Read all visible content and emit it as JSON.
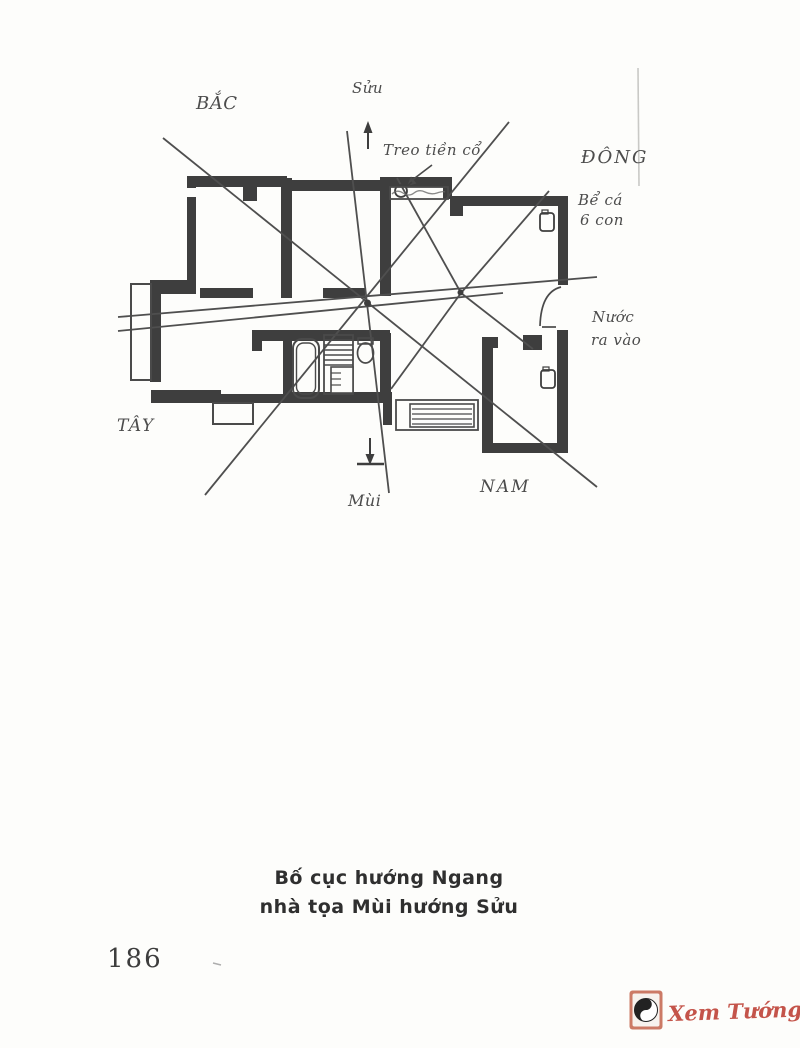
{
  "page": {
    "background": "#fdfdfb",
    "number": "186",
    "caption_line1": "Bố cục hướng Ngang",
    "caption_line2": "nhà tọa Mùi hướng Sửu"
  },
  "diagram": {
    "type": "feng-shui floor plan sketch with compass sector lines",
    "ink_color": "#3e3e3e",
    "labels": {
      "north": "BẮC",
      "north_mountain": "Sửu",
      "east": "ĐÔNG",
      "west": "TÂY",
      "south": "NAM",
      "south_mountain": "Mùi",
      "hang_old_coins": "Treo tiền cổ",
      "fish_tank_line1": "Bể cá",
      "fish_tank_line2": "6 con",
      "water_line1": "Nước",
      "water_line2": "ra vào"
    }
  },
  "watermark": {
    "text": "Xem Tướng.net",
    "color": "#c4544a",
    "logo": "yin-yang"
  }
}
